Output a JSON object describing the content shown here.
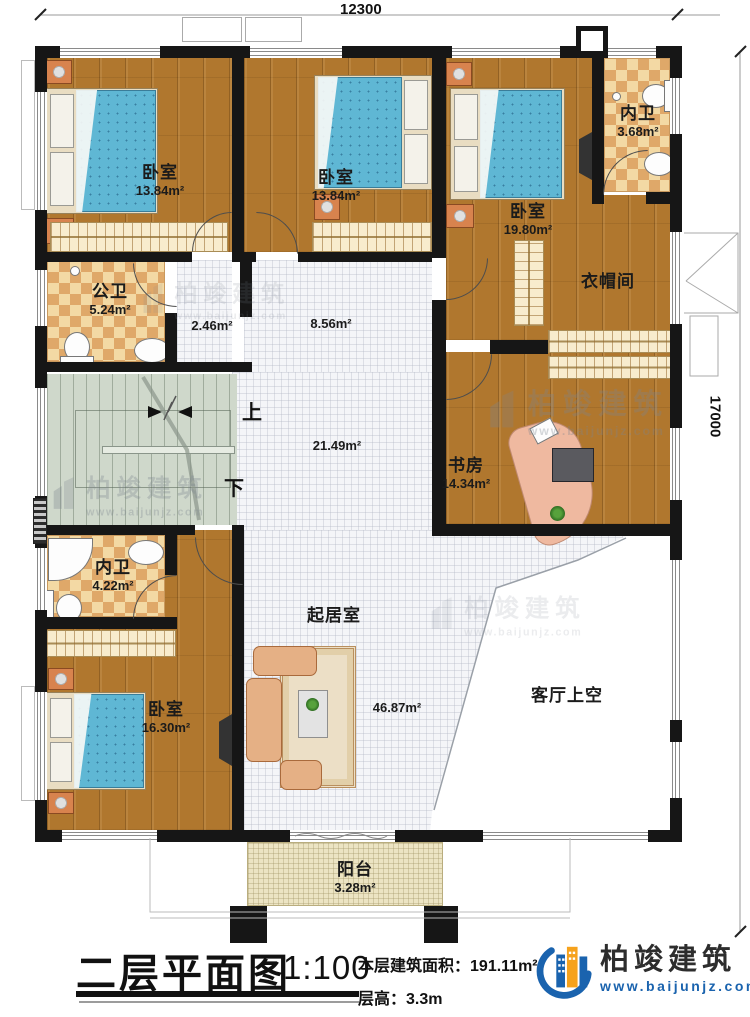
{
  "dimensions": {
    "top": "12300",
    "right": "17000"
  },
  "rooms": {
    "bedroom1": {
      "name": "卧室",
      "area": "13.84m²"
    },
    "bedroom2": {
      "name": "卧室",
      "area": "13.84m²"
    },
    "bedroom3": {
      "name": "卧室",
      "area": "19.80m²"
    },
    "bath_top": {
      "name": "内卫",
      "area": "3.68m²"
    },
    "cloakroom": {
      "name": "衣帽间"
    },
    "public_bath": {
      "name": "公卫",
      "area": "5.24m²"
    },
    "corridor": {
      "area": "2.46m²"
    },
    "hall_upper": {
      "area": "8.56m²"
    },
    "hall_main": {
      "area": "21.49m²"
    },
    "study": {
      "name": "书房",
      "area": "14.34m²"
    },
    "bath_lower": {
      "name": "内卫",
      "area": "4.22m²"
    },
    "bedroom4": {
      "name": "卧室",
      "area": "16.30m²"
    },
    "living": {
      "name": "起居室",
      "area": "46.87m²"
    },
    "void": {
      "name": "客厅上空"
    },
    "balcony": {
      "name": "阳台",
      "area": "3.28m²"
    }
  },
  "stairs": {
    "up": "上",
    "down": "下"
  },
  "watermark": {
    "name": "柏竣建筑",
    "url": "www.baijunjz.com"
  },
  "titleblock": {
    "title": "二层平面图",
    "scale": "1:100",
    "area_label": "本层建筑面积：",
    "area_value": "191.11m²",
    "floor_height_label": "层高：",
    "floor_height_value": "3.3m"
  },
  "brand": {
    "name": "柏竣建筑",
    "url": "www.baijunjz.com"
  },
  "colors": {
    "accent_blue": "#1a63ae",
    "accent_orange": "#f6a21c",
    "wall": "#161616"
  }
}
